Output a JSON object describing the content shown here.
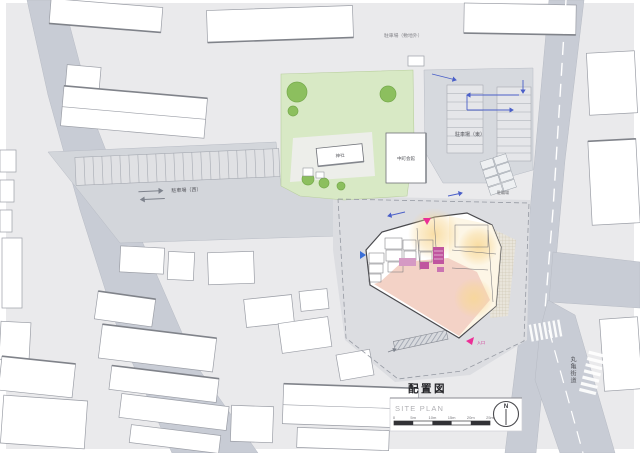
{
  "titleblock": {
    "title_jp": "配置図",
    "title_en": "SITE PLAN",
    "scale_ticks": [
      "0",
      "5m",
      "10m",
      "15m",
      "20m",
      "25m"
    ],
    "north_label": "N"
  },
  "map_labels": {
    "parking_west": "駐車場（西）",
    "parking_east": "駐車場（東）",
    "parking_offsite": "駐車場（敷地外）",
    "community_hall": "中町会館",
    "shrine": "神社",
    "bike_parking": "駐輪場",
    "road_name": "丸亀街道",
    "entrance": "入口"
  },
  "colors": {
    "road": "#c9cdd6",
    "block": "#eaeaec",
    "site_ground": "#dcdde1",
    "park_green": "#d8e9c5",
    "tree_green": "#8cbf5e",
    "hall_salmon": "#f3d2c6",
    "warm_glow": "#f8d896",
    "core_magenta": "#c0559f",
    "entrance_pink": "#ec2f96",
    "arrow_blue": "#4a5fc8"
  }
}
